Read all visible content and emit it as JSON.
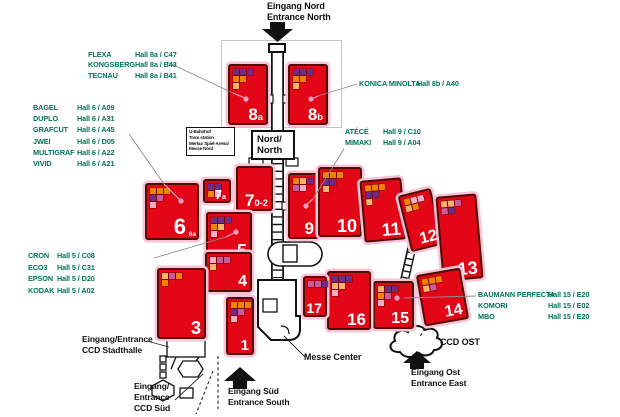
{
  "colors": {
    "hall_fill": "#e30617",
    "hall_border": "#4f0f00",
    "hall_halo": "#f6c3d8",
    "exhibitor_green": "#00745c",
    "stand_palette": {
      "o": "#f08300",
      "pe": "#f5b36b",
      "p": "#6f2c85",
      "r": "#c85c9d",
      "pk": "#f3aec6"
    }
  },
  "entrances": {
    "north": {
      "line1": "Eingang Nord",
      "line2": "Entrance North"
    },
    "south": {
      "line1": "Eingang Süd",
      "line2": "Entrance South"
    },
    "east": {
      "line1": "Eingang Ost",
      "line2": "Entrance East"
    },
    "ccd_stadthalle": {
      "line1": "Eingang/Entrance",
      "line2": "CCD Stadthalle"
    },
    "ccd_sued": {
      "line1": "Eingang/",
      "line2": "Entrance",
      "line3": "CCD Süd"
    }
  },
  "landmarks": {
    "messe_center": "Messe Center",
    "ccd_ost": "CCD OST",
    "nord_box": {
      "line1": "Nord/",
      "line2": "North"
    },
    "station_box": [
      "U-Bahnhof",
      "Tram station",
      "Merkur Spiel-Arena/",
      "Messe Nord"
    ]
  },
  "exhibitor_lists": [
    {
      "id": "hall8a",
      "entries": [
        {
          "name": "FLEXA",
          "loc": "Hall 8a / C47"
        },
        {
          "name": "KONGSBERG",
          "loc": "Hall 8a / B43"
        },
        {
          "name": "TECNAU",
          "loc": "Hall 8a / B41"
        }
      ]
    },
    {
      "id": "hall6",
      "entries": [
        {
          "name": "BAGEL",
          "loc": "Hall 6 / A09"
        },
        {
          "name": "DUPLO",
          "loc": "Hall 6 / A31"
        },
        {
          "name": "GRAFCUT",
          "loc": "Hall 6 / A45"
        },
        {
          "name": "JWEI",
          "loc": "Hall 6 / D05"
        },
        {
          "name": "MULTIGRAF",
          "loc": "Hall 6 / A22"
        },
        {
          "name": "VIVID",
          "loc": "Hall 6 / A21"
        }
      ]
    },
    {
      "id": "hall8b",
      "entries": [
        {
          "name": "KONICA MINOLTA",
          "loc": "Hall 8b / A40"
        }
      ]
    },
    {
      "id": "hall9",
      "entries": [
        {
          "name": "ATÉCÉ",
          "loc": "Hall 9 / C10"
        },
        {
          "name": "MIMAKI",
          "loc": "Hall 9 / A04"
        }
      ]
    },
    {
      "id": "hall5",
      "entries": [
        {
          "name": "CRON",
          "loc": "Hall 5 / C08"
        },
        {
          "name": "ECO3",
          "loc": "Hall 5 / C31"
        },
        {
          "name": "EPSON",
          "loc": "Hall 5 / D20"
        },
        {
          "name": "KODAK",
          "loc": "Hall 5 / A02"
        }
      ]
    },
    {
      "id": "hall15",
      "entries": [
        {
          "name": "BAUMANN PERFECTA",
          "loc": "Hall 15 / E20"
        },
        {
          "name": "KOMORI",
          "loc": "Hall 15 / E02"
        },
        {
          "name": "MBO",
          "loc": "Hall 15 / E20"
        }
      ]
    }
  ],
  "halls": [
    {
      "id": "8a",
      "num": "8",
      "sub": "a",
      "x": 228,
      "y": 64,
      "w": 40,
      "h": 61,
      "rot": 0,
      "fs": 17,
      "stands": [
        [
          "p",
          "p",
          "p"
        ],
        [
          "o",
          "o"
        ],
        [
          "pe"
        ]
      ]
    },
    {
      "id": "8b",
      "num": "8",
      "sub": "b",
      "x": 288,
      "y": 64,
      "w": 40,
      "h": 61,
      "rot": 0,
      "fs": 17,
      "stands": [
        [
          "p",
          "p",
          "p"
        ],
        [
          "o",
          "o"
        ],
        [
          "pe"
        ]
      ]
    },
    {
      "id": "6",
      "num": "6",
      "corner": "6a",
      "x": 145,
      "y": 183,
      "w": 54,
      "h": 57,
      "rot": 0,
      "fs": 22,
      "stands": [
        [
          "o",
          "o",
          "o"
        ],
        [
          "p",
          "r"
        ],
        [
          "pk"
        ]
      ]
    },
    {
      "id": "7a",
      "num": "7",
      "sub": "a",
      "x": 203,
      "y": 179,
      "w": 28,
      "h": 24,
      "rot": 0,
      "fs": 13,
      "stands": [
        [
          "p",
          "p"
        ],
        [
          "o",
          "pk"
        ]
      ]
    },
    {
      "id": "7.0-2",
      "num": "7",
      "sub": "0-2",
      "x": 236,
      "y": 166,
      "w": 37,
      "h": 45,
      "rot": 0,
      "fs": 17,
      "stands": []
    },
    {
      "id": "5",
      "num": "5",
      "x": 206,
      "y": 212,
      "w": 46,
      "h": 50,
      "rot": 0,
      "fs": 18,
      "stands": [
        [
          "p",
          "p",
          "p"
        ],
        [
          "o",
          "pe"
        ],
        [
          "pk"
        ]
      ]
    },
    {
      "id": "4",
      "num": "4",
      "x": 205,
      "y": 252,
      "w": 47,
      "h": 40,
      "rot": 0,
      "fs": 16,
      "stands": [
        [
          "pk",
          "r",
          "r"
        ],
        [
          "pe"
        ]
      ]
    },
    {
      "id": "3",
      "num": "3",
      "x": 157,
      "y": 268,
      "w": 49,
      "h": 71,
      "rot": 0,
      "fs": 18,
      "stands": [
        [
          "pe",
          "r",
          "o"
        ],
        [
          "o"
        ]
      ]
    },
    {
      "id": "1",
      "num": "1",
      "x": 226,
      "y": 297,
      "w": 28,
      "h": 58,
      "rot": 0,
      "fs": 15,
      "stands": [
        [
          "o",
          "o",
          "o"
        ],
        [
          "p",
          "r"
        ],
        [
          "pk"
        ]
      ]
    },
    {
      "id": "9",
      "num": "9",
      "x": 288,
      "y": 173,
      "w": 31,
      "h": 66,
      "rot": 0,
      "fs": 17,
      "stands": [
        [
          "o",
          "pe",
          "p"
        ],
        [
          "r",
          "pk"
        ]
      ]
    },
    {
      "id": "10",
      "num": "10",
      "x": 318,
      "y": 167,
      "w": 44,
      "h": 70,
      "rot": 0,
      "fs": 18,
      "stands": [
        [
          "o",
          "o",
          "o"
        ],
        [
          "p",
          "p"
        ],
        [
          "pe"
        ]
      ]
    },
    {
      "id": "11",
      "num": "11",
      "x": 362,
      "y": 179,
      "w": 42,
      "h": 62,
      "rot": -5,
      "fs": 18,
      "stands": [
        [
          "o",
          "o",
          "o"
        ],
        [
          "p",
          "p"
        ],
        [
          "pe"
        ]
      ]
    },
    {
      "id": "12",
      "num": "12",
      "x": 404,
      "y": 191,
      "w": 34,
      "h": 58,
      "rot": -14,
      "fs": 16,
      "stands": [
        [
          "o",
          "pk",
          "pk"
        ],
        [
          "pe",
          "o"
        ]
      ]
    },
    {
      "id": "13",
      "num": "13",
      "x": 439,
      "y": 195,
      "w": 41,
      "h": 85,
      "rot": -5,
      "fs": 18,
      "stands": [
        [
          "pe",
          "pe",
          "r"
        ],
        [
          "r",
          "p"
        ]
      ]
    },
    {
      "id": "14",
      "num": "14",
      "x": 420,
      "y": 271,
      "w": 45,
      "h": 52,
      "rot": -10,
      "fs": 16,
      "stands": [
        [
          "o",
          "o",
          "o"
        ],
        [
          "pe",
          "r"
        ]
      ]
    },
    {
      "id": "15",
      "num": "15",
      "x": 373,
      "y": 281,
      "w": 41,
      "h": 48,
      "rot": 0,
      "fs": 16,
      "stands": [
        [
          "pe",
          "p",
          "p"
        ],
        [
          "o",
          "r"
        ],
        [
          "pk"
        ]
      ]
    },
    {
      "id": "16",
      "num": "16",
      "x": 327,
      "y": 271,
      "w": 44,
      "h": 59,
      "rot": 0,
      "fs": 17,
      "stands": [
        [
          "p",
          "p",
          "p"
        ],
        [
          "pe",
          "pe"
        ],
        [
          "pk"
        ]
      ]
    },
    {
      "id": "17",
      "num": "17",
      "x": 303,
      "y": 276,
      "w": 24,
      "h": 41,
      "rot": 0,
      "fs": 14,
      "stands": [
        [
          "r",
          "r",
          "p"
        ]
      ]
    }
  ]
}
